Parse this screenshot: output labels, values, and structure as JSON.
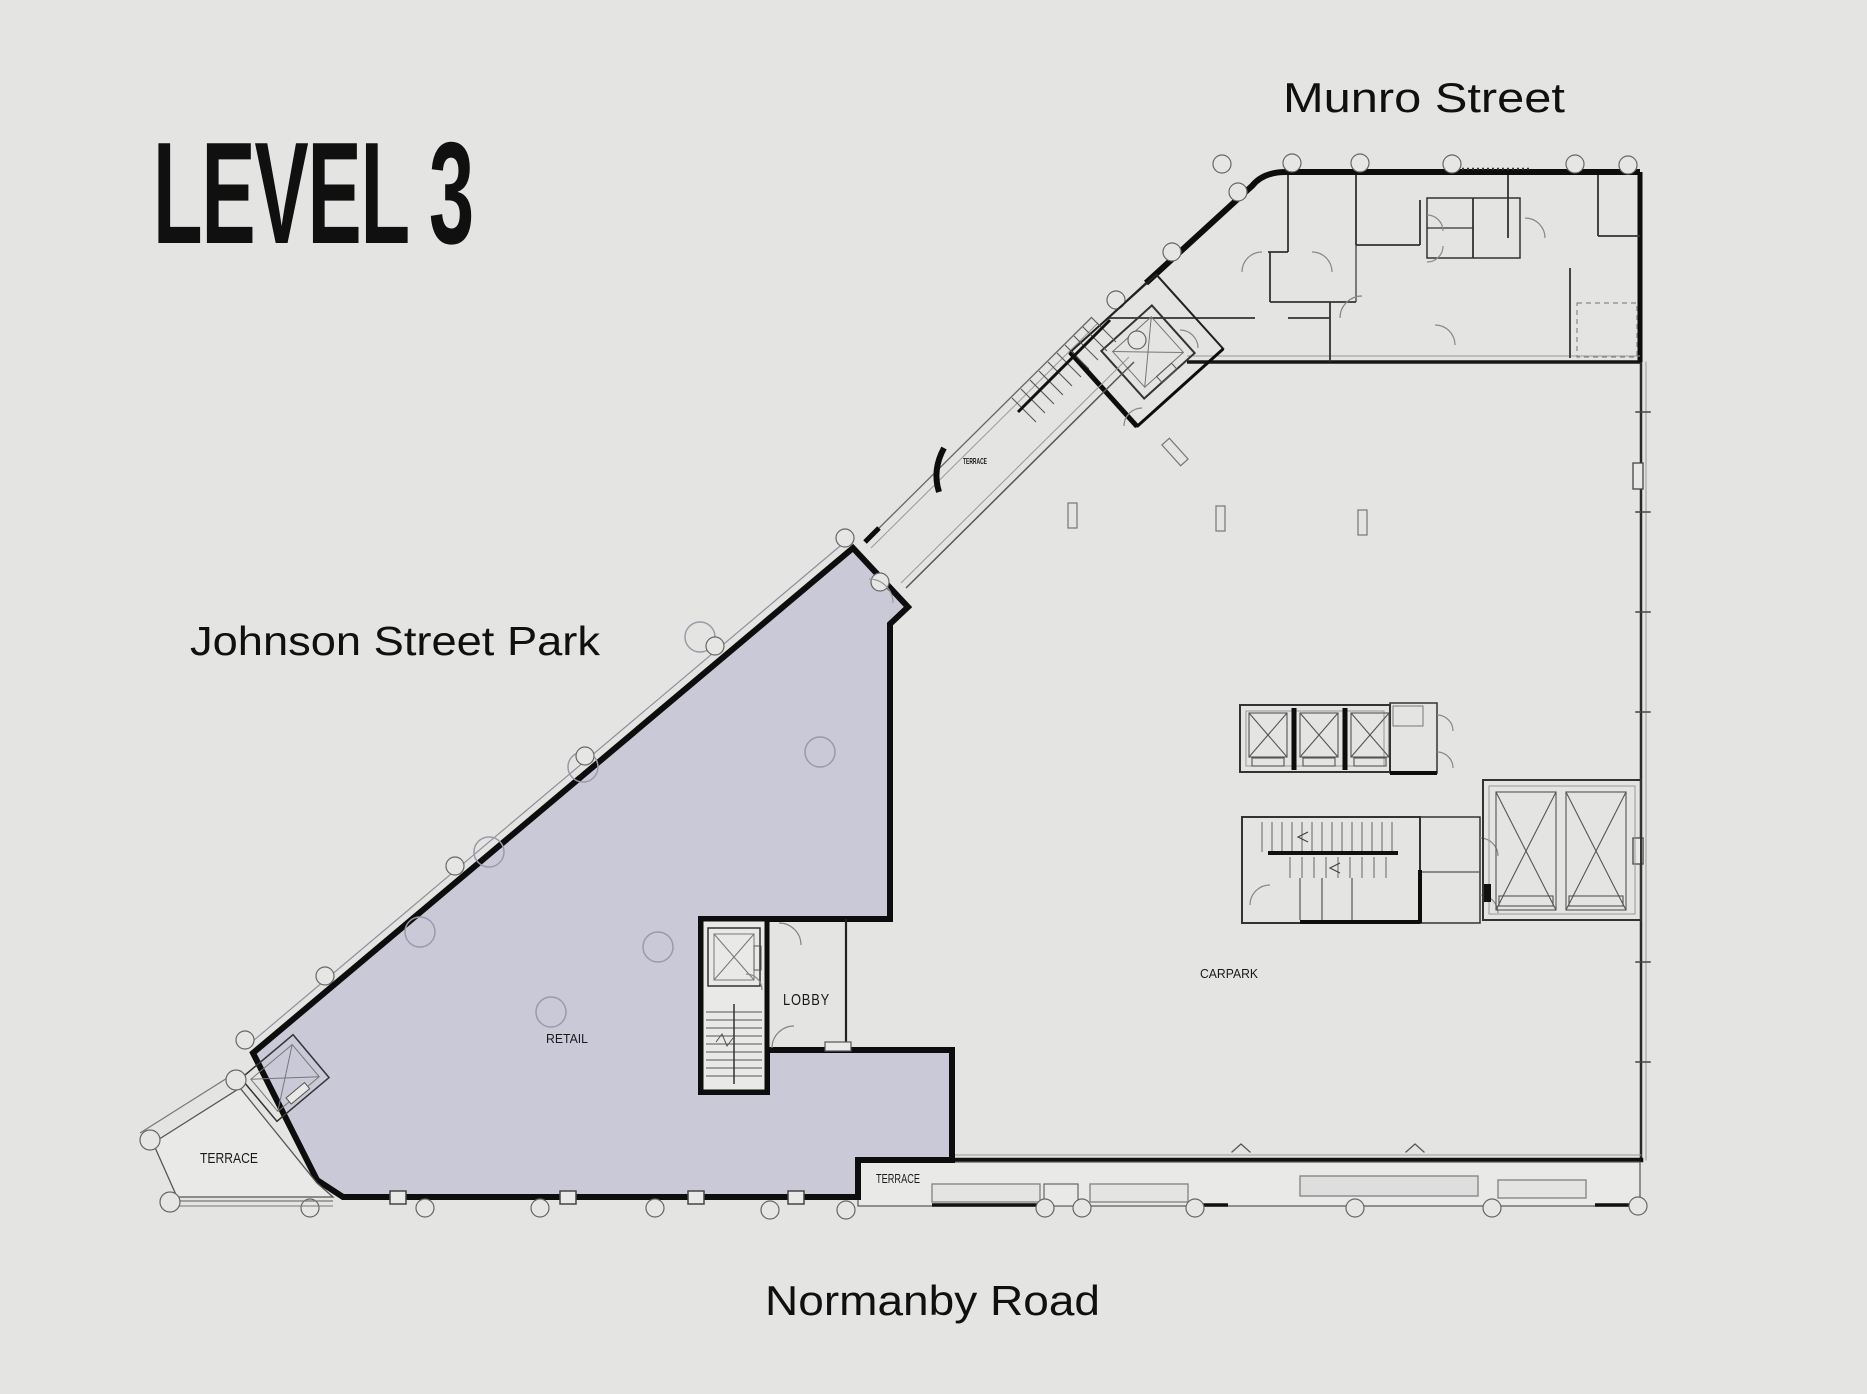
{
  "title": "LEVEL 3",
  "streets": {
    "top": "Munro Street",
    "left": "Johnson Street Park",
    "bottom": "Normanby Road"
  },
  "rooms": {
    "retail": "RETAIL",
    "lobby": "LOBBY",
    "carpark": "CARPARK",
    "terrace_left": "TERRACE",
    "terrace_bottom": "TERRACE",
    "terrace_link": "TERRACE"
  },
  "colors": {
    "background": "#e4e4e3",
    "retail_fill": "#c9c9d8",
    "wall": "#0d0d0d",
    "thin_line": "#666666",
    "light_room": "#e9e9e8"
  }
}
